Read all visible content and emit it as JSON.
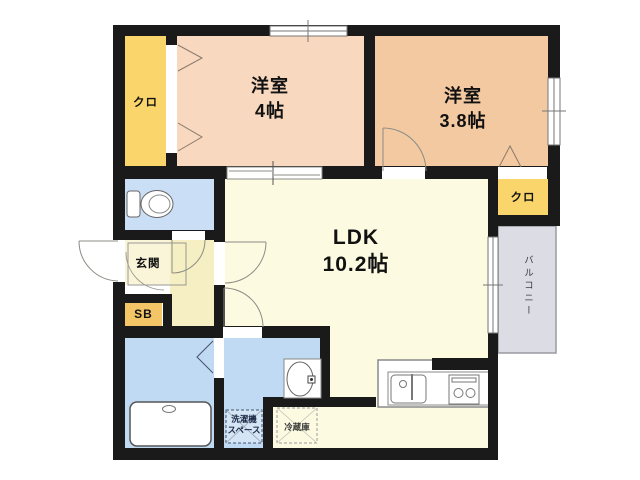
{
  "title": "1LDK+2room apartment floor plan",
  "colors": {
    "wall": "#1a1a1a",
    "bedroom1_floor": "#f8d8bf",
    "bedroom2_floor": "#f3c9a2",
    "closet_floor": "#fad56b",
    "shoebox_floor": "#f4c566",
    "ldk_floor": "#fdfae2",
    "hall_floor": "#f5efc3",
    "entrance_floor": "#faf5d8",
    "wet_area_floor": "#bfdaf2",
    "toilet_floor": "#cadff5",
    "balcony_floor": "#dcdce4"
  },
  "rooms": {
    "bedroom1": {
      "name": "洋室",
      "size": "4帖"
    },
    "bedroom2": {
      "name": "洋室",
      "size": "3.8帖"
    },
    "ldk": {
      "name": "LDK",
      "size": "10.2帖"
    },
    "closet_left": {
      "label": "クロ"
    },
    "closet_right": {
      "label": "クロ"
    },
    "entrance": {
      "label": "玄関"
    },
    "shoe_box": {
      "label": "SB"
    },
    "balcony": {
      "label": "バルコニー"
    },
    "washing_machine_space": {
      "line1": "洗濯機",
      "line2": "スペース"
    },
    "refrigerator": {
      "label": "冷蔵庫"
    }
  }
}
